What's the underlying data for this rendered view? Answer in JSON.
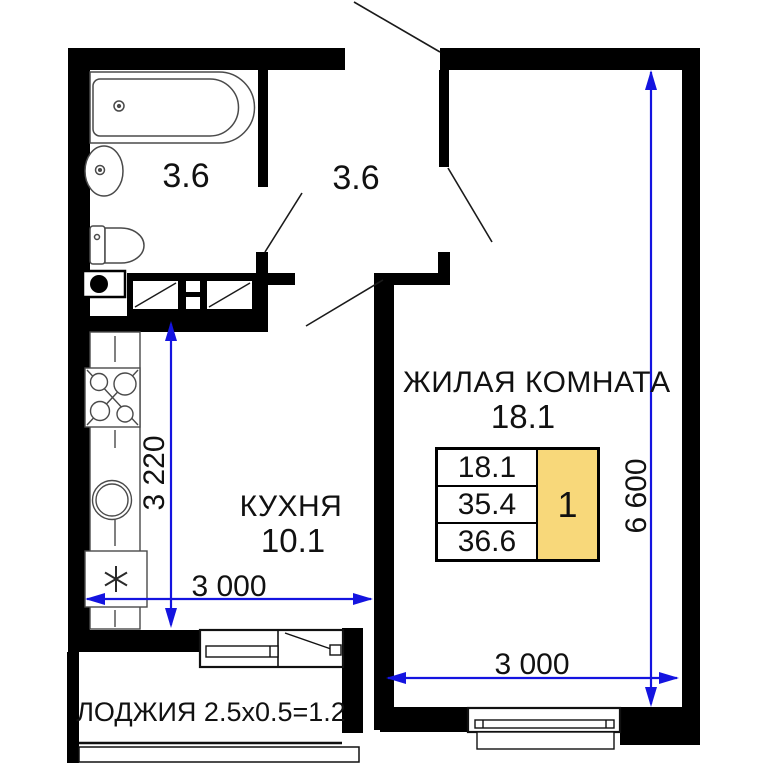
{
  "floorplan": {
    "rooms": {
      "bathroom": {
        "area": "3.6"
      },
      "hallway": {
        "area": "3.6"
      },
      "living_room": {
        "name": "ЖИЛАЯ КОМНАТА",
        "area": "18.1"
      },
      "kitchen": {
        "name": "КУХНЯ",
        "area": "10.1"
      },
      "loggia": {
        "label": "ЛОДЖИЯ 2.5x0.5=1.2"
      }
    },
    "dimensions": {
      "kitchen_width": "3 000",
      "kitchen_depth": "3 220",
      "living_width": "3 000",
      "living_depth": "6 600"
    },
    "info_table": {
      "living_area": "18.1",
      "apartment_area": "35.4",
      "total_area": "36.6",
      "rooms_count": "1"
    },
    "colors": {
      "wall": "#000000",
      "dimension_line": "#1414e0",
      "rooms_badge_fill": "#f8d87a"
    }
  }
}
